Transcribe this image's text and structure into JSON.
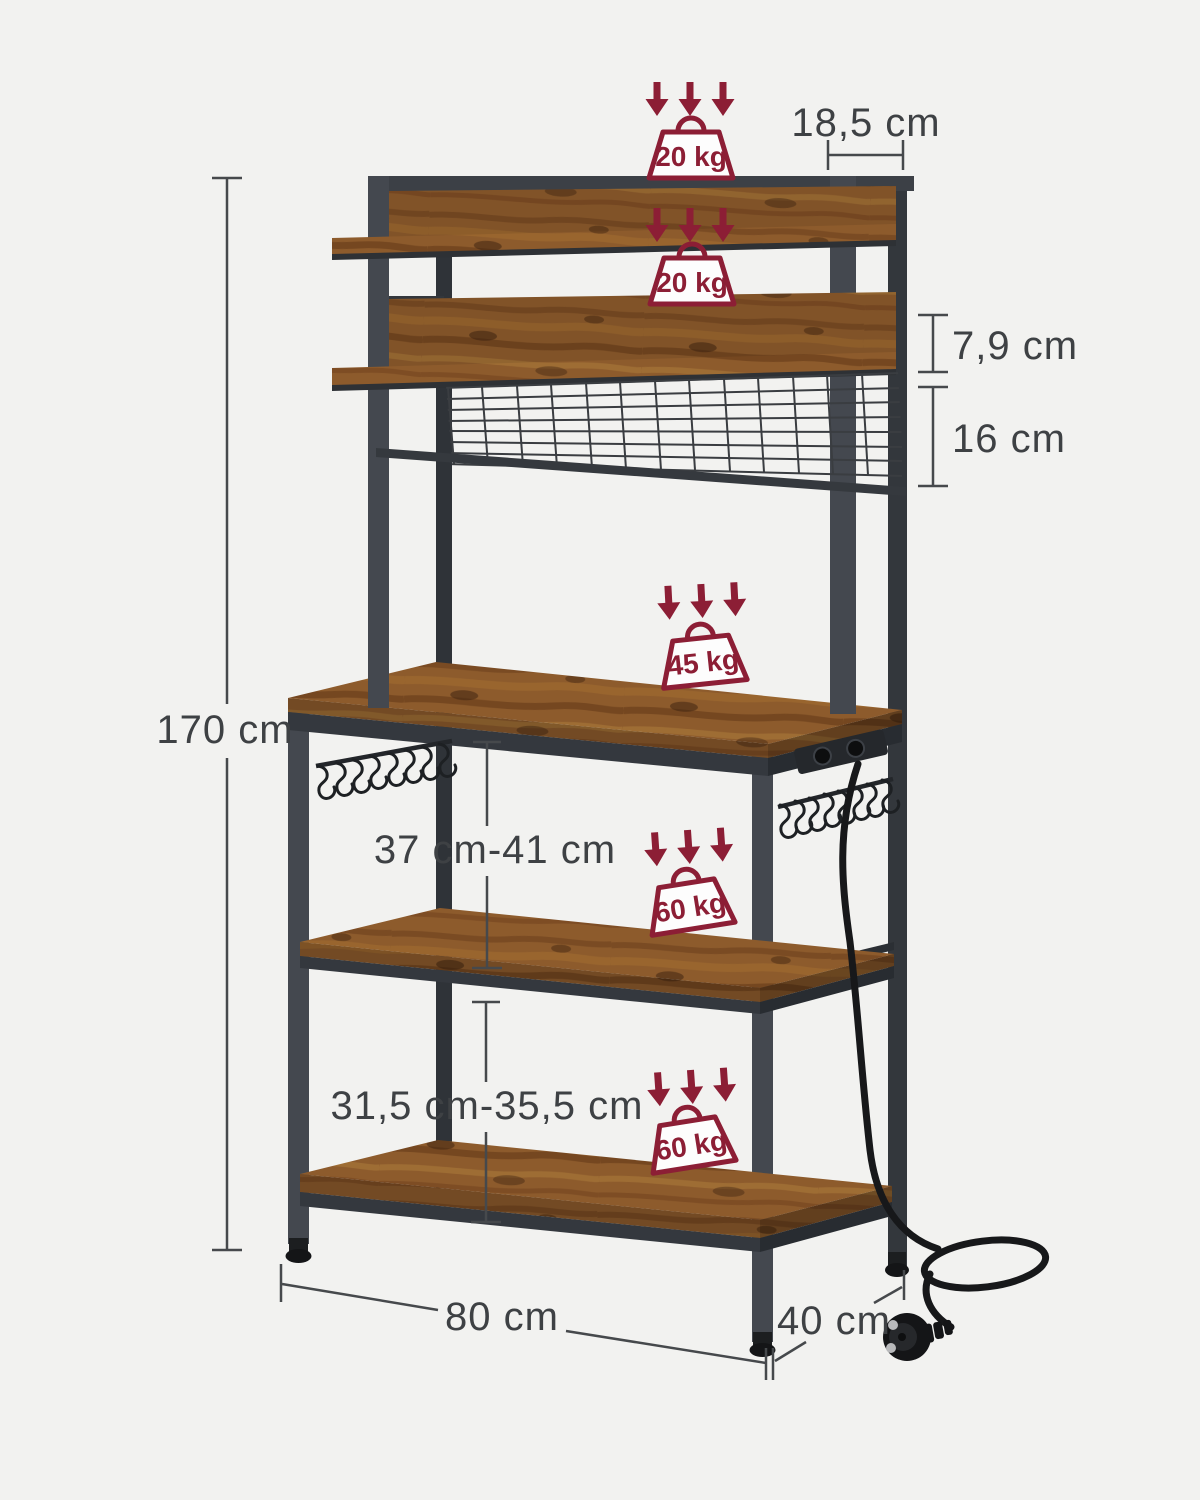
{
  "colors": {
    "background": "#f2f2f0",
    "accent_maroon": "#8c1e35",
    "dimension_text": "#3e4144",
    "metal_dark": "#44484f",
    "metal_side": "#2f3338",
    "wood_base": "#8d5b2c"
  },
  "dims": {
    "top_depth": "18,5 cm",
    "lip_height": "7,9 cm",
    "mesh_height": "16 cm",
    "total_height": "170 cm",
    "mid_clearance": "37 cm-41 cm",
    "bottom_clearance": "31,5 cm-35,5 cm",
    "width": "80 cm",
    "depth": "40 cm"
  },
  "capacities": {
    "top_shelf": "20 kg",
    "second_shelf": "20 kg",
    "worktop": "45 kg",
    "middle_shelf": "60 kg",
    "bottom_shelf": "60 kg"
  }
}
